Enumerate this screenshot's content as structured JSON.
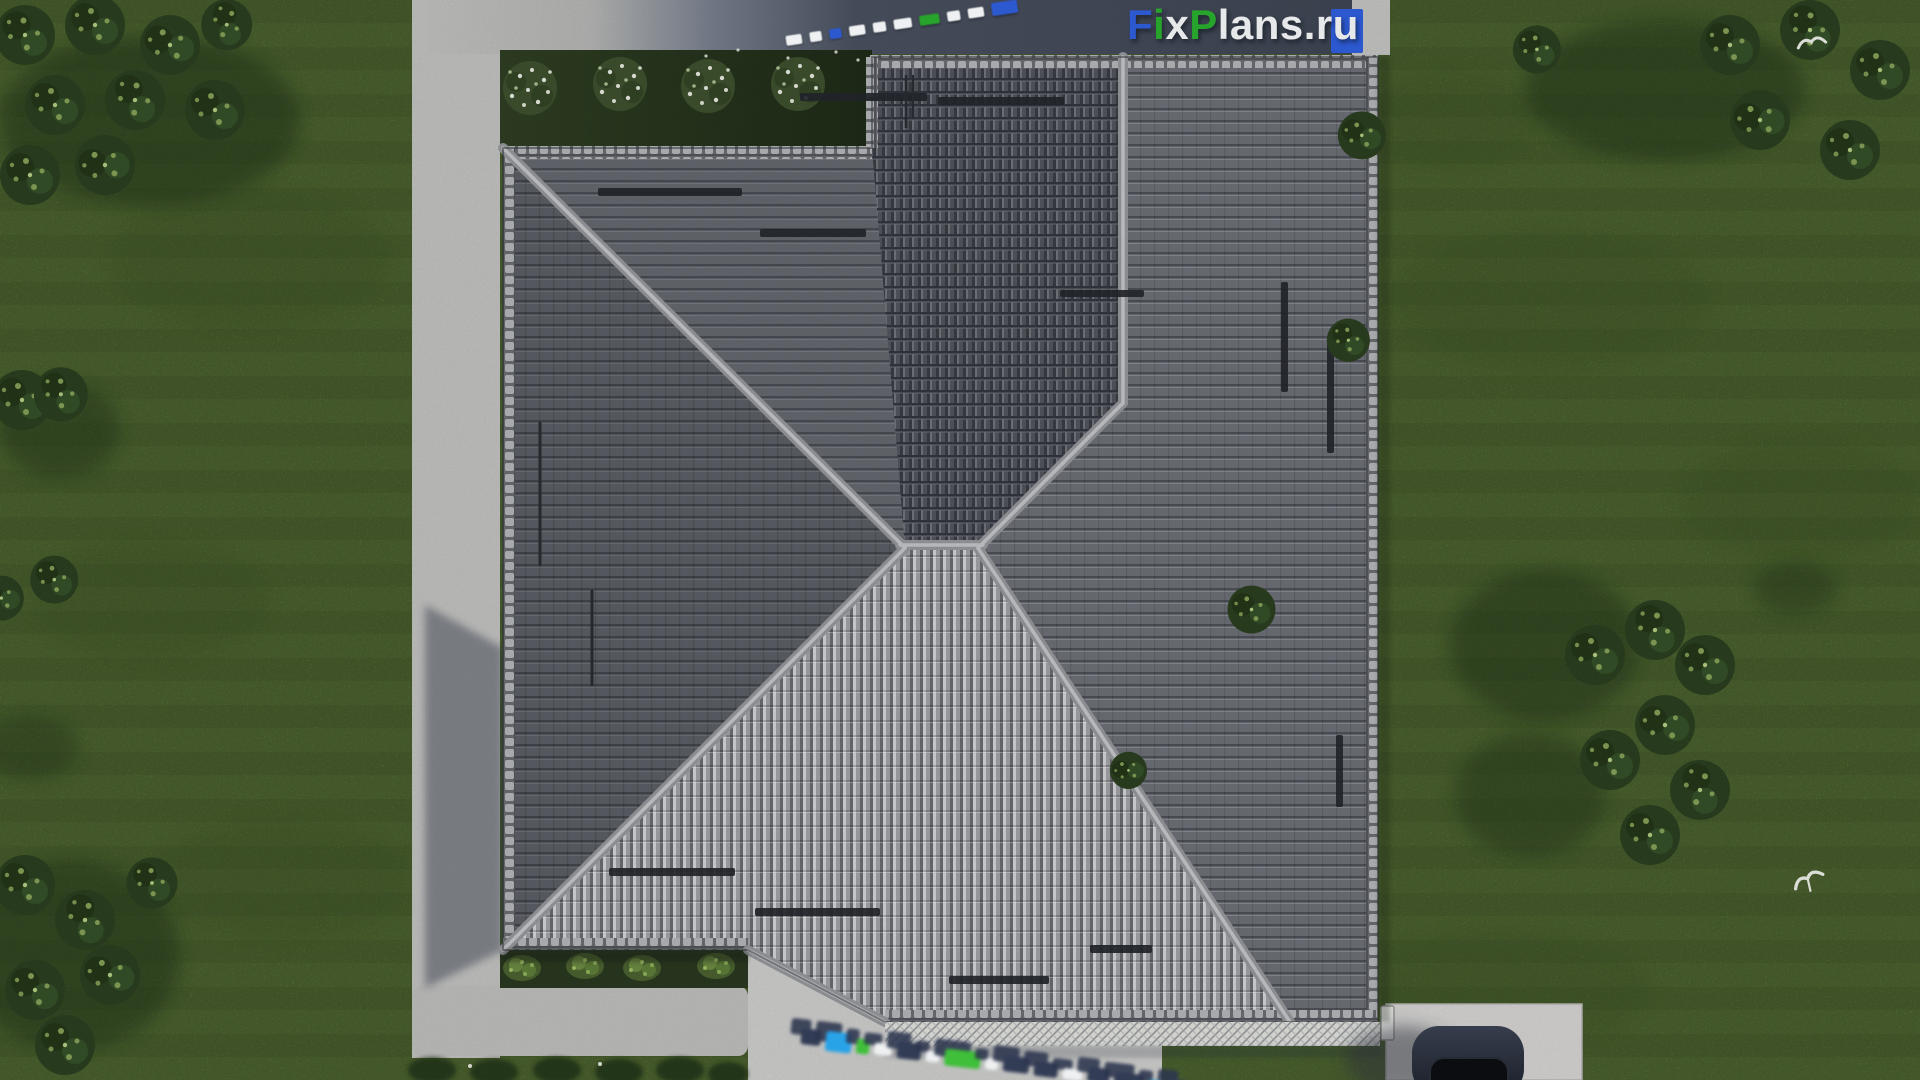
{
  "site_logo": {
    "full_text": "FixPlans.ru",
    "segments": [
      {
        "text": "F",
        "color": "blue"
      },
      {
        "text": "i",
        "color": "green"
      },
      {
        "text": "x",
        "color": "white"
      },
      {
        "text": "P",
        "color": "green"
      },
      {
        "text": "lans",
        "color": "white"
      },
      {
        "text": ".",
        "color": "white"
      },
      {
        "text": "r",
        "color": "white"
      },
      {
        "text": "u",
        "color": "white_on_blue"
      }
    ]
  },
  "watermarks": {
    "top_diagonal": "FixPlans.ru",
    "bottom_ground": "FixPlans.ru"
  },
  "palette": {
    "logo_blue": "#2d59d0",
    "logo_green": "#27a42b",
    "logo_white": "#e7e8ea",
    "watermark_cyan": "#29a3e8",
    "watermark_green": "#3fbf3a",
    "watermark_navy": "#323c55",
    "grass": "#5e7a3b",
    "roof_dark": "#53565d",
    "roof_medium": "#6e7177",
    "roof_bright": "#a2a4a8",
    "ridge_cap": "#a8aaad",
    "pavement": "#c7c7c5",
    "shadow_band_dark": "#3f4654",
    "car_body": "#2b3240"
  },
  "scene_objects": {
    "building": "hip-roof house, top-down view",
    "vehicle": "dark car on driveway",
    "ground": "lawn with tree clusters and shrubs",
    "paths": "concrete path, patio and driveway",
    "birds_count": 2
  }
}
